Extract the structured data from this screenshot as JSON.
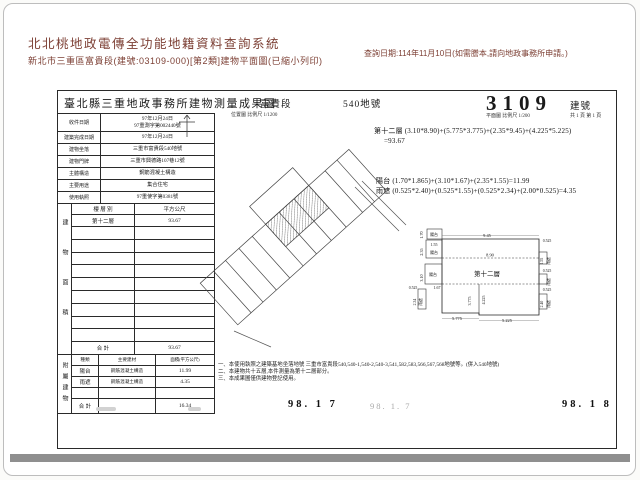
{
  "header": {
    "system_title": "北北桃地政電傳全功能地籍資料查詢系統",
    "subtitle": "新北市三重區富貴段(建號:03109-000)[第2類]建物平面圖(已縮小列印)",
    "query_date": "查詢日期:114年11月10日(如需謄本,請向地政事務所申請。)"
  },
  "form": {
    "title": "臺北縣三重地政事務所建物測量成果圖",
    "section_name": "富貴段",
    "parcel_no": "540地號",
    "map_scale": "位置圖 比例尺 1/1200",
    "building_no": "3109",
    "building_no_unit": "建號",
    "plan_scale": "平面圖 比例尺 1/200",
    "page_info": "共 1 頁 第 1 頁",
    "info_rows": [
      {
        "label": "收件日期",
        "value": "97年12月24日",
        "value2": "97重測字第002440號"
      },
      {
        "label": "建築完成日期",
        "value": "97年12月24日"
      },
      {
        "label": "建物坐落",
        "value": "三重市富貴段540地號"
      },
      {
        "label": "建物門牌",
        "value": "三重市興德路107巷12號"
      },
      {
        "label": "主體構造",
        "value": "鋼筋混凝土構造"
      },
      {
        "label": "主要用途",
        "value": "集合住宅"
      },
      {
        "label": "使用執照",
        "value": "97重使字第0381號"
      }
    ],
    "floor_table": {
      "section_title": "建物面積",
      "col_floor": "樓 層 別",
      "col_area": "平方公尺",
      "floor": "第十二層",
      "area": "93.67",
      "total_label": "合 計",
      "total": "93.67"
    },
    "annex_table": {
      "section_title": "附屬建物",
      "col_kind": "種類",
      "col_material": "主要建材",
      "col_area": "面積(平方公尺)",
      "rows": [
        {
          "kind": "陽台",
          "material": "鋼筋混凝土構造",
          "area": "11.99"
        },
        {
          "kind": "雨遮",
          "material": "鋼筋混凝土構造",
          "area": "4.35"
        }
      ],
      "total_label": "合 計",
      "total": "16.34"
    },
    "formulas": {
      "floor_line1": "第十二層 (3.10*8.90)+(5.775*3.775)+(2.35*9.45)+(4.225*5.225)",
      "floor_line2": "=93.67",
      "balcony": "陽台 (1.70*1.865)+(3.10*1.67)+(2.35*1.55)=11.99",
      "canopy": "雨遮 (0.525*2.40)+(0.525*1.55)+(0.525*2.34)+(2.00*0.525)=4.35"
    },
    "notes": [
      "一、本使用執照之建築基地坐落地號 三重市富貴段540,540-1,540-2,540-3,541,582,583,566,567,568地號等。(併入540地號)",
      "二、本建物共十五層,本件測量為第十二層部分。",
      "三、本成果圖僅供建物登記使用。"
    ],
    "stamps": {
      "date1": "98. 1  7",
      "date_faint": "98. 1. 7",
      "date2": "98. 1  8"
    }
  },
  "plan": {
    "labels": [
      {
        "t": "1.70",
        "x": 16,
        "y": 10,
        "r": -90
      },
      {
        "t": "陽台",
        "x": 27,
        "y": 11,
        "s": 4
      },
      {
        "t": "2.35",
        "x": 16,
        "y": 27,
        "r": -90
      },
      {
        "t": "1.55",
        "x": 27,
        "y": 21,
        "s": 4
      },
      {
        "t": "陽台",
        "x": 27,
        "y": 29,
        "s": 4
      },
      {
        "t": "9.45",
        "x": 80,
        "y": 12,
        "s": 4.4
      },
      {
        "t": "0.525",
        "x": 140,
        "y": 17,
        "s": 3.8
      },
      {
        "t": "8.90",
        "x": 83,
        "y": 31.5,
        "s": 4.4
      },
      {
        "t": "1.55",
        "x": 136,
        "y": 36,
        "r": -90,
        "s": 3.8
      },
      {
        "t": "雨遮",
        "x": 143,
        "y": 36,
        "r": -90,
        "s": 3.8
      },
      {
        "t": "3.10",
        "x": 16,
        "y": 53,
        "r": -90
      },
      {
        "t": "陽台",
        "x": 26,
        "y": 51,
        "s": 4
      },
      {
        "t": "第十二層",
        "x": 80,
        "y": 51,
        "s": 6.5
      },
      {
        "t": "0.525",
        "x": 140,
        "y": 47,
        "s": 3.8
      },
      {
        "t": "雨遮",
        "x": 143,
        "y": 57,
        "r": -90,
        "s": 3.8
      },
      {
        "t": "1.67",
        "x": 30,
        "y": 64,
        "s": 4
      },
      {
        "t": "0.525",
        "x": 6,
        "y": 64,
        "s": 3.8
      },
      {
        "t": "2.34",
        "x": 9,
        "y": 77,
        "r": -90,
        "s": 3.8
      },
      {
        "t": "雨遮",
        "x": 15,
        "y": 77,
        "r": -90,
        "s": 3.8
      },
      {
        "t": "3.775",
        "x": 64,
        "y": 76,
        "r": -90,
        "s": 4
      },
      {
        "t": "4.225",
        "x": 78,
        "y": 75,
        "r": -90,
        "s": 4
      },
      {
        "t": "0.525",
        "x": 140,
        "y": 66,
        "s": 3.8
      },
      {
        "t": "2.40",
        "x": 136,
        "y": 79,
        "r": -90,
        "s": 3.8
      },
      {
        "t": "雨遮",
        "x": 143,
        "y": 79,
        "r": -90,
        "s": 3.8
      },
      {
        "t": "5.775",
        "x": 50,
        "y": 95,
        "s": 4.4
      },
      {
        "t": "5.225",
        "x": 100,
        "y": 97,
        "s": 4.4
      }
    ]
  }
}
